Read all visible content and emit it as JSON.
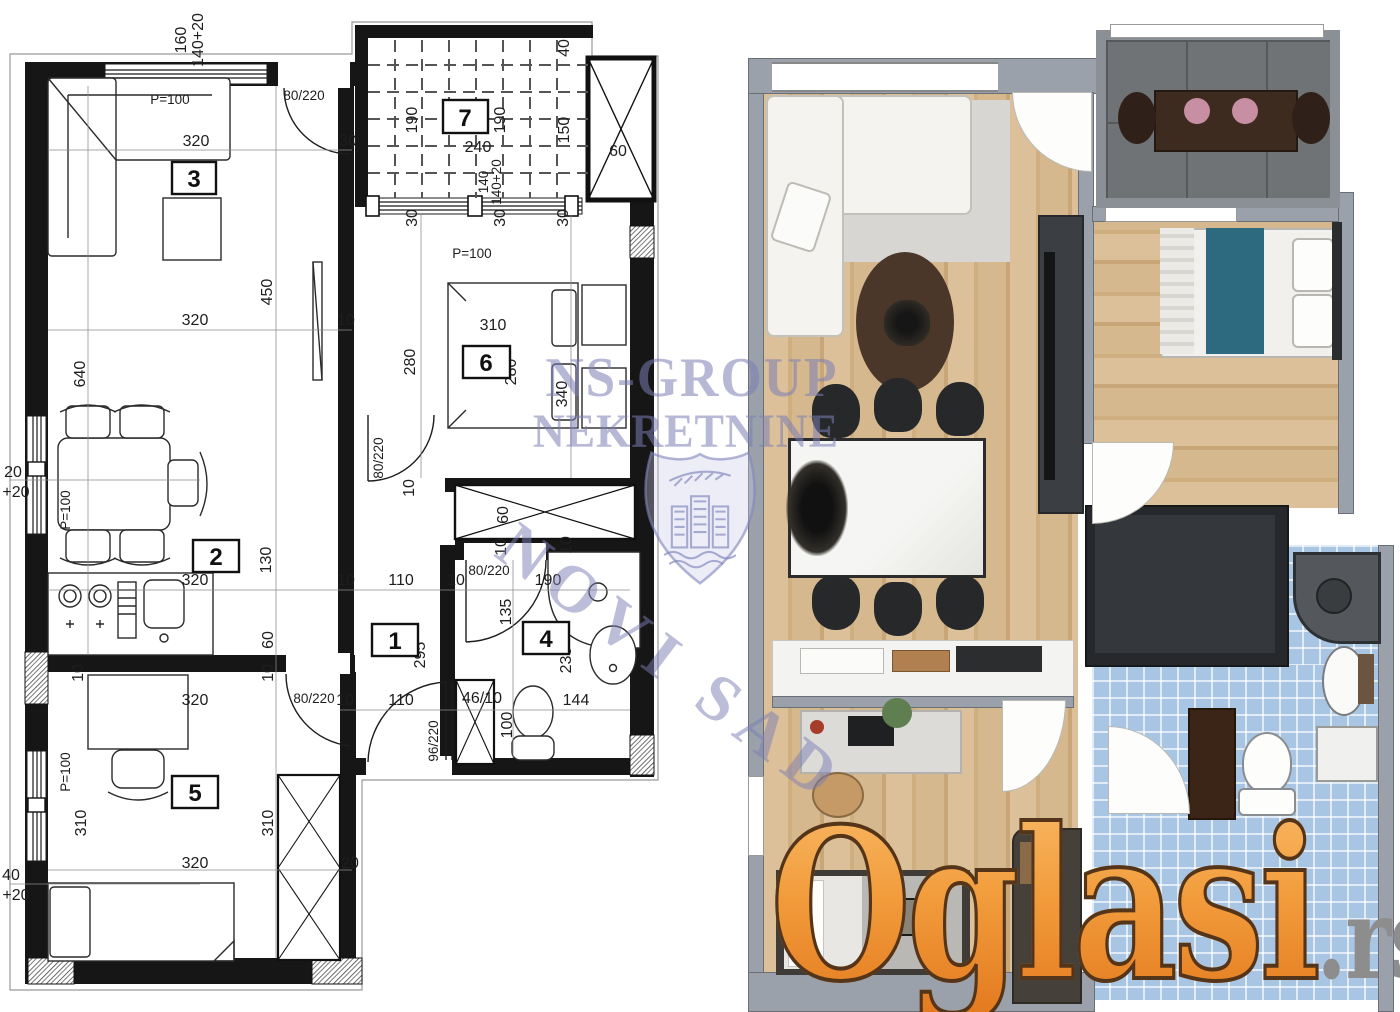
{
  "watermark": {
    "line1": "NS-GROUP",
    "line2": "NEKRETNINE",
    "diagonal": "NOVI SAD",
    "color": "#7a7eb4"
  },
  "logo": {
    "main": "Oglasi",
    "tld": ".rs",
    "orange": "#ef8a26",
    "gray": "#8d8d8d"
  },
  "left_plan": {
    "rooms": [
      "1",
      "2",
      "3",
      "4",
      "5",
      "6",
      "7"
    ],
    "d": [
      "160",
      "140+20",
      "P=100",
      "80/220",
      "320",
      "30",
      "190",
      "240",
      "190",
      "40",
      "150",
      "60",
      "30",
      "140",
      "140+20",
      "30",
      "30",
      "P=100",
      "450",
      "320",
      "10",
      "640",
      "280",
      "310",
      "280",
      "340",
      "P=100",
      "20",
      "+20",
      "80/220",
      "10",
      "60",
      "10",
      "10",
      "130",
      "320",
      "10",
      "110",
      "10",
      "80/220",
      "190",
      "135",
      "295",
      "235",
      "60",
      "10",
      "10",
      "320",
      "10",
      "110",
      "46/10",
      "100",
      "144",
      "96/220",
      "80/220",
      "P=100",
      "310",
      "40",
      "+20",
      "310",
      "320",
      "20"
    ]
  },
  "right_plan": {
    "colors": {
      "wall": "#9ba1aa",
      "wood": "#d6b88e",
      "terrace_tile": "#6f7376",
      "bath_tile": "#a9c5e4",
      "bed_teal": "#2d6a80",
      "dark_furniture": "#3b3e42",
      "island_white": "#f3f3f1",
      "cabinet_brown": "#3a2517"
    }
  }
}
